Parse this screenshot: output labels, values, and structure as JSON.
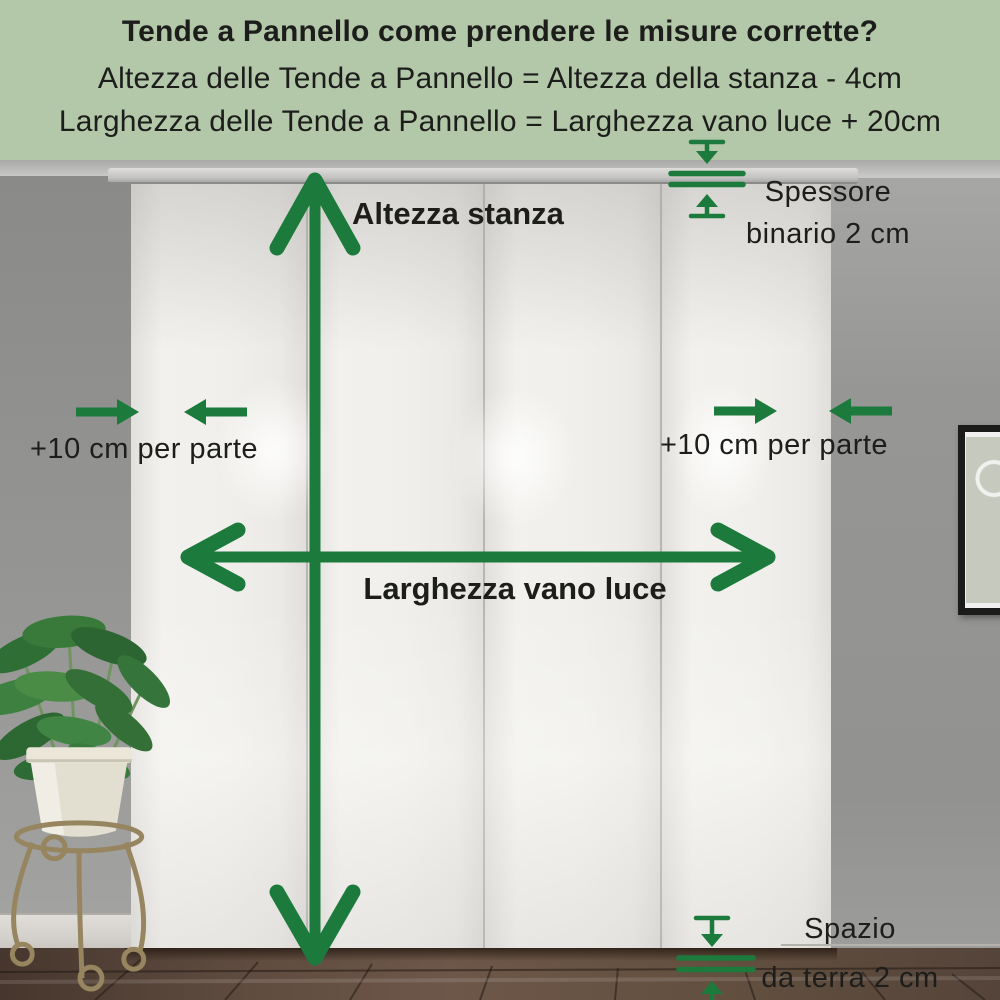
{
  "header": {
    "title": "Tende a Pannello come prendere le misure corrette?",
    "formulas": [
      "Altezza delle Tende a Pannello = Altezza della stanza - 4cm",
      "Larghezza delle Tende a Pannello = Larghezza vano luce + 20cm"
    ]
  },
  "labels": {
    "room_height": "Altezza stanza",
    "track_thickness_line1": "Spessore",
    "track_thickness_line2": "binario 2 cm",
    "side_allowance_left": "+10 cm per parte",
    "side_allowance_right": "+10 cm per parte",
    "opening_width": "Larghezza vano luce",
    "floor_gap_line1": "Spazio",
    "floor_gap_line2": "da terra 2 cm"
  },
  "icons": {
    "room_height_arrow": "vertical double-headed measuring arrow",
    "opening_width_arrow": "horizontal double-headed measuring arrow",
    "side_allowance_arrows": "two opposing horizontal arrows on each side",
    "track_thickness_gauge": "two lines with inward arrows (2 cm track)",
    "floor_gap_gauge": "two lines with inward arrows (2 cm floor gap)"
  },
  "colors": {
    "header_background": "#b3c7a9",
    "annotation_green": "#1c7a3c",
    "text": "#1d1d1b"
  }
}
